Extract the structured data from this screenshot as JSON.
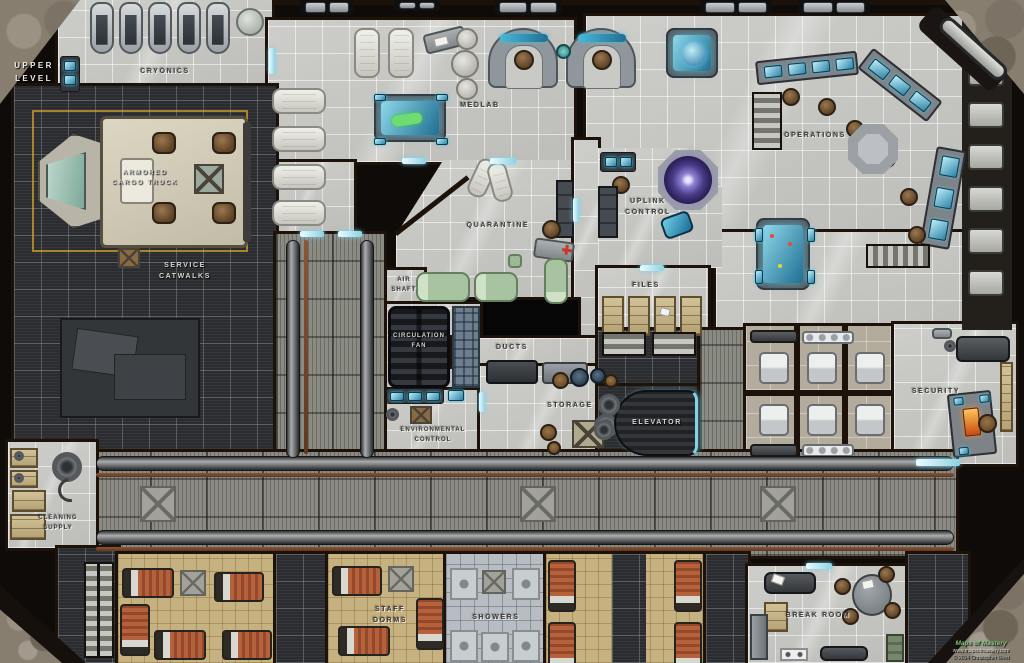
{
  "map": {
    "title": {
      "line1": "Mining",
      "line2": "Colony"
    },
    "level": {
      "line1": "Upper",
      "line2": "Level"
    },
    "rooms": {
      "cryonics": {
        "label": "Cryonics"
      },
      "medlab": {
        "label": "Medlab"
      },
      "operations": {
        "label": "Operations"
      },
      "quarantine": {
        "label": "Quarantine"
      },
      "uplink": {
        "line1": "Uplink",
        "line2": "Control"
      },
      "files": {
        "label": "Files"
      },
      "airshaft": {
        "line1": "Air",
        "line2": "Shaft"
      },
      "fan": {
        "line1": "Circulation",
        "line2": "Fan"
      },
      "ducts": {
        "label": "Ducts"
      },
      "storage": {
        "label": "Storage"
      },
      "env": {
        "line1": "Environmental",
        "line2": "Control"
      },
      "elevator": {
        "label": "Elevator"
      },
      "security": {
        "label": "Security"
      },
      "truck": {
        "line1": "Armored",
        "line2": "Cargo Truck"
      },
      "catwalks": {
        "line1": "Service",
        "line2": "Catwalks"
      },
      "cleaning": {
        "line1": "Cleaning",
        "line2": "Supply"
      },
      "dorms": {
        "line1": "Staff",
        "line2": "Dorms"
      },
      "showers": {
        "label": "Showers"
      },
      "breakroom": {
        "label": "Break Room"
      }
    },
    "credits": {
      "publisher": "Maps of Mastery",
      "url": "www.mapsofmastery.com",
      "copyright": "© 2014 Christopher West"
    },
    "colors": {
      "holo_blue": "#4ec0e0",
      "door_cyan": "#8fd2e4",
      "dish_purple": "#8d7fd4",
      "floor_gray": "#c8c8c5"
    }
  }
}
